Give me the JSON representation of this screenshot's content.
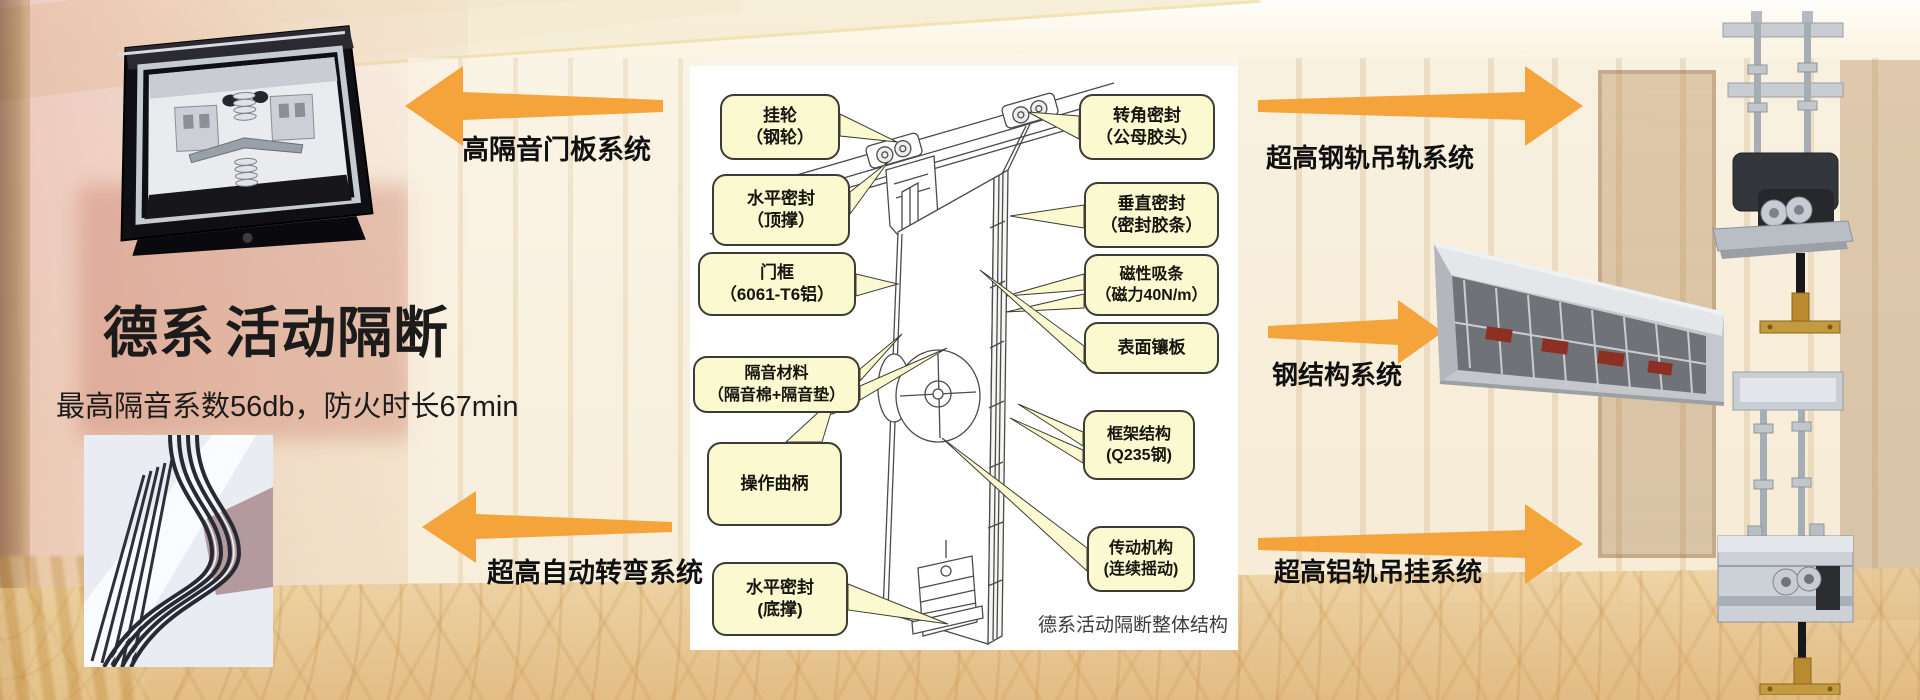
{
  "brand": {
    "title_primary": "德系",
    "title_secondary": "活动隔断",
    "subtitle": "最高隔音系数56db，防火时长67min"
  },
  "arrows": {
    "left_top": {
      "label": "高隔音门板系统"
    },
    "left_bottom": {
      "label": "超高自动转弯系统"
    },
    "right_top": {
      "label": "超高钢轨吊轨系统"
    },
    "right_middle": {
      "label": "钢结构系统"
    },
    "right_bottom": {
      "label": "超高铝轨吊挂系统"
    }
  },
  "diagram": {
    "caption": "德系活动隔断整体结构",
    "left_labels": [
      {
        "line1": "挂轮",
        "line2": "（钢轮）"
      },
      {
        "line1": "水平密封",
        "line2": "（顶撑）"
      },
      {
        "line1": "门框",
        "line2": "（6061-T6铝）"
      },
      {
        "line1": "隔音材料",
        "line2": "（隔音棉+隔音垫）"
      },
      {
        "line1": "操作曲柄",
        "line2": ""
      },
      {
        "line1": "水平密封",
        "line2": "(底撑)"
      }
    ],
    "right_labels": [
      {
        "line1": "转角密封",
        "line2": "（公母胶头）"
      },
      {
        "line1": "垂直密封",
        "line2": "（密封胶条）"
      },
      {
        "line1": "磁性吸条",
        "line2": "（磁力40N/m）"
      },
      {
        "line1": "表面镶板",
        "line2": ""
      },
      {
        "line1": "框架结构",
        "line2": "(Q235钢)"
      },
      {
        "line1": "传动机构",
        "line2": "(连续摇动)"
      }
    ]
  },
  "colors": {
    "arrow": "#F5A43C",
    "bubble_fill": "#FBF9CF",
    "bubble_border": "#3C3C34",
    "text": "#1B1B1B"
  }
}
